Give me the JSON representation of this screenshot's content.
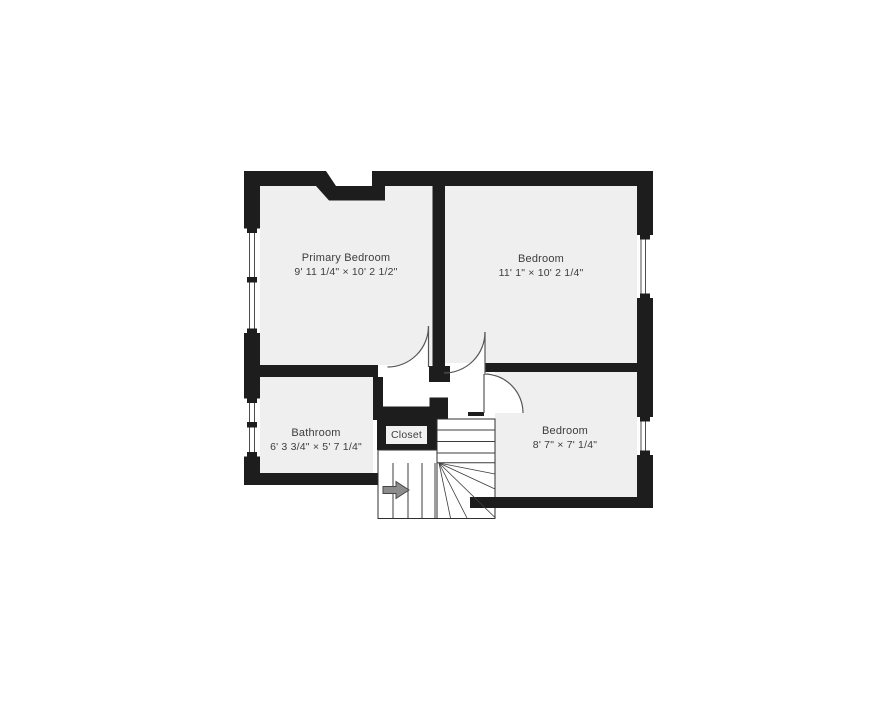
{
  "page": {
    "background_color": "#ffffff"
  },
  "floor_plan": {
    "colors": {
      "wall": "#1d1d1d",
      "room_floor": "#efefef",
      "hallway": "#ffffff",
      "door_line": "#565656",
      "stair_line": "#3c3c3c",
      "label_text": "#3d3d3d",
      "arrow_fill": "#8c8c8c",
      "arrow_outline": "#474747"
    },
    "rooms": [
      {
        "name": "Primary Bedroom",
        "dimensions": "9' 11 1/4\" × 10' 2 1/2\""
      },
      {
        "name": "Bedroom",
        "dimensions": "11' 1\" × 10' 2 1/4\""
      },
      {
        "name": "Bathroom",
        "dimensions": "6' 3 3/4\" × 5' 7 1/4\""
      },
      {
        "name": "Closet"
      },
      {
        "name": "Bedroom",
        "dimensions": "8' 7\" × 7' 1/4\""
      }
    ],
    "stairs": {
      "direction_arrow": "right"
    }
  }
}
